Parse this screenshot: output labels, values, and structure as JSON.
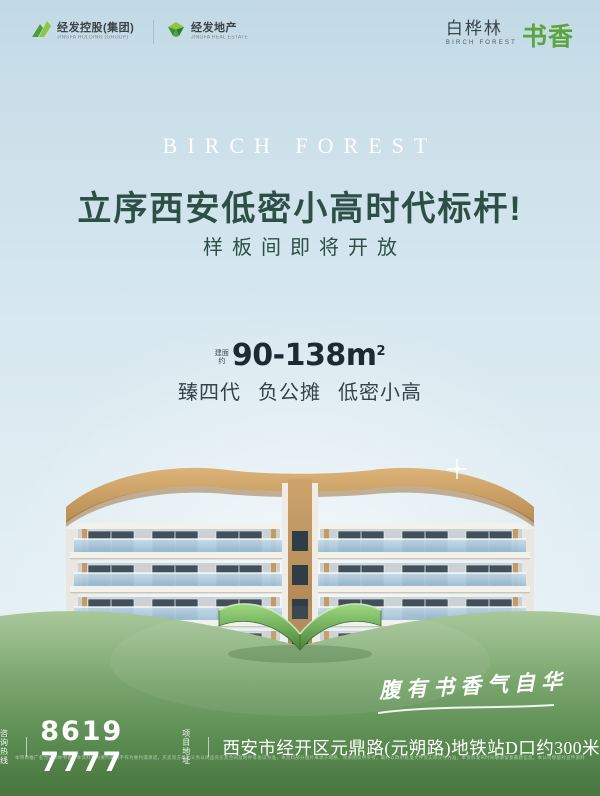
{
  "header": {
    "logo_group": {
      "name": "经发控股(集团)",
      "subtitle": "JINGFA HOLDING (GROUP)"
    },
    "logo_estate": {
      "name": "经发地产",
      "subtitle": "JINGFA REAL ESTATE"
    },
    "brand": {
      "zh_main": "白桦林",
      "zh_accent": "书香",
      "en": "BIRCH FOREST"
    }
  },
  "hero": {
    "en_title": "BIRCH FOREST",
    "headline": "立序西安低密小高时代标杆!",
    "subheadline": "样板间即将开放"
  },
  "area": {
    "prefix_line1": "建面",
    "prefix_line2": "约",
    "value": "90-138m",
    "value_sup": "2",
    "tags": [
      "臻四代",
      "负公摊",
      "低密小高"
    ]
  },
  "slogan": "腹有书香气自华",
  "contact": {
    "hotline_label_line1": "咨询",
    "hotline_label_line2": "热线",
    "hotline_number": "8619 7777",
    "address_label_line1": "项目",
    "address_label_line2": "地址",
    "address": "西安市经开区元鼎路(元朔路)地铁站D口约300米"
  },
  "disclaimer": "本项目推广名为白桦林书香，本资料仅为要约邀请不作为要约或承诺，买卖双方权利义务以商品房买卖合同及附件等协议为准，本资料部分图片来源于网络，效果图仅供参考，最终以政府批准文件及实际交付为准，本资料发布时间敬请留意最新信息，本公司保留对宣传资料修改的权利，解释权归本公司所有。",
  "colors": {
    "headline_green": "#2e4f45",
    "brand_green": "#5ba43e",
    "dark_text": "#1e2a33",
    "ground_green": "#6f9c64"
  }
}
